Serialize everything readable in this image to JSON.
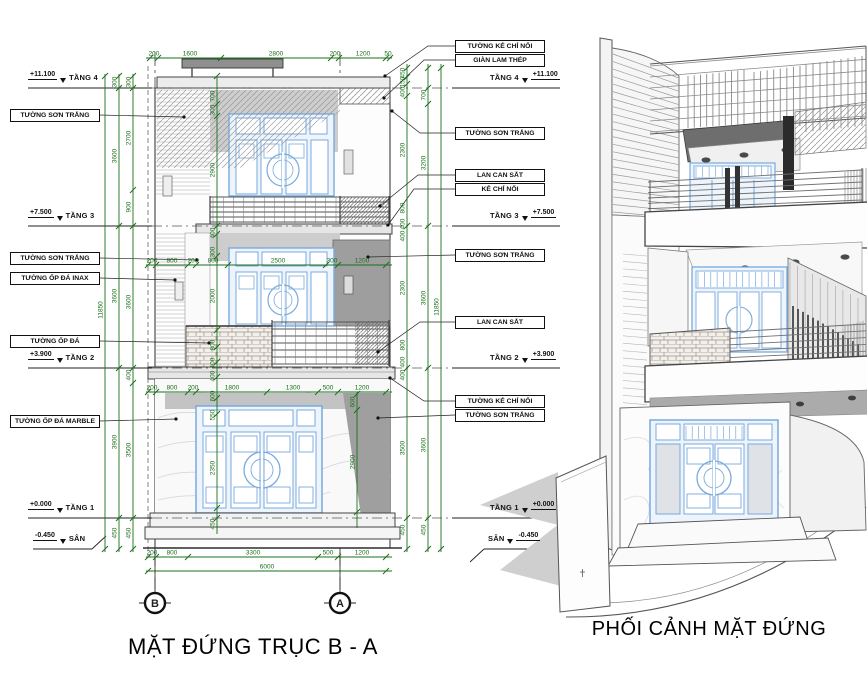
{
  "titles": {
    "elevation": "MẶT ĐỨNG TRỤC B - A",
    "perspective": "PHỐI CẢNH MẶT ĐỨNG"
  },
  "grid_bubbles": {
    "left": "B",
    "right": "A"
  },
  "levels": {
    "t4": {
      "name": "TẦNG 4",
      "elev": "+11.100"
    },
    "t3": {
      "name": "TẦNG 3",
      "elev": "+7.500"
    },
    "t2": {
      "name": "TẦNG 2",
      "elev": "+3.900"
    },
    "t1": {
      "name": "TẦNG 1",
      "elev": "+0.000"
    },
    "san": {
      "name": "SÂN",
      "elev": "-0.450"
    }
  },
  "callouts_left": [
    "TƯỜNG SƠN TRẮNG",
    "TƯỜNG SƠN TRẮNG",
    "TƯỜNG ỐP ĐÁ INAX",
    "TƯỜNG ỐP ĐÁ",
    "TƯỜNG ỐP ĐÁ MARBLE"
  ],
  "callouts_right": [
    "TƯỜNG KẺ CHỈ NỔI",
    "GIÀN LAM THÉP",
    "TƯỜNG SƠN TRẮNG",
    "LAN CAN SẮT",
    "KẺ CHỈ NỔI",
    "TƯỜNG SƠN TRẮNG",
    "LAN CAN SẮT",
    "TƯỜNG KẺ CHỈ NỔI",
    "TƯỜNG SƠN TRẮNG"
  ],
  "colors": {
    "dim_green": "#1b6f1b",
    "door_blue": "#79aadd",
    "line_dark": "#3d3d3d"
  },
  "dim_chains": [
    {
      "dir": "h",
      "pos": 58,
      "from": 146,
      "to": 392,
      "ticks": [
        150,
        158,
        221,
        331,
        339,
        386,
        390
      ],
      "labels": [
        {
          "v": "200",
          "at": 154
        },
        {
          "v": "1600",
          "at": 190
        },
        {
          "v": "2800",
          "at": 276
        },
        {
          "v": "200",
          "at": 335
        },
        {
          "v": "1200",
          "at": 363
        },
        {
          "v": "50",
          "at": 388
        }
      ]
    },
    {
      "dir": "h",
      "pos": 265,
      "from": 146,
      "to": 392,
      "ticks": [
        148,
        156,
        188,
        196,
        228,
        326,
        338,
        386
      ],
      "labels": [
        {
          "v": "200",
          "at": 152
        },
        {
          "v": "800",
          "at": 172
        },
        {
          "v": "200",
          "at": 193
        },
        {
          "v": "800",
          "at": 213
        },
        {
          "v": "2500",
          "at": 278
        },
        {
          "v": "300",
          "at": 332
        },
        {
          "v": "1200",
          "at": 362
        }
      ]
    },
    {
      "dir": "h",
      "pos": 392,
      "from": 146,
      "to": 392,
      "ticks": [
        148,
        156,
        188,
        196,
        267,
        318,
        338,
        386
      ],
      "labels": [
        {
          "v": "200",
          "at": 152
        },
        {
          "v": "800",
          "at": 172
        },
        {
          "v": "200",
          "at": 193
        },
        {
          "v": "1800",
          "at": 232
        },
        {
          "v": "1300",
          "at": 293
        },
        {
          "v": "500",
          "at": 328
        },
        {
          "v": "1200",
          "at": 362
        }
      ]
    },
    {
      "dir": "h",
      "pos": 557,
      "from": 146,
      "to": 392,
      "ticks": [
        148,
        156,
        188,
        318,
        338,
        386
      ],
      "labels": [
        {
          "v": "200",
          "at": 152
        },
        {
          "v": "800",
          "at": 172
        },
        {
          "v": "3300",
          "at": 253
        },
        {
          "v": "500",
          "at": 328
        },
        {
          "v": "1200",
          "at": 362
        }
      ]
    },
    {
      "dir": "h",
      "pos": 571,
      "from": 146,
      "to": 392,
      "ticks": [
        148,
        386
      ],
      "labels": [
        {
          "v": "6000",
          "at": 267
        }
      ]
    },
    {
      "dir": "v",
      "pos": 105,
      "from": 74,
      "to": 552,
      "ticks": [
        76,
        549
      ],
      "labels": [
        {
          "v": "11850",
          "at": 310
        }
      ]
    },
    {
      "dir": "v",
      "pos": 119,
      "from": 74,
      "to": 552,
      "ticks": [
        76,
        88,
        226,
        368,
        518,
        549
      ],
      "labels": [
        {
          "v": "300",
          "at": 82
        },
        {
          "v": "3600",
          "at": 156
        },
        {
          "v": "3600",
          "at": 296
        },
        {
          "v": "3900",
          "at": 442
        },
        {
          "v": "450",
          "at": 533
        }
      ]
    },
    {
      "dir": "v",
      "pos": 133,
      "from": 74,
      "to": 552,
      "ticks": [
        76,
        88,
        190,
        226,
        368,
        383,
        518,
        549
      ],
      "labels": [
        {
          "v": "300",
          "at": 82
        },
        {
          "v": "2700",
          "at": 138
        },
        {
          "v": "900",
          "at": 207
        },
        {
          "v": "3600",
          "at": 302
        },
        {
          "v": "400",
          "at": 375
        },
        {
          "v": "3500",
          "at": 450
        },
        {
          "v": "450",
          "at": 533
        }
      ]
    },
    {
      "dir": "v",
      "pos": 217,
      "from": 76,
      "to": 534,
      "ticks": [
        76,
        104,
        116,
        226,
        234,
        256,
        330,
        347,
        362,
        377,
        398,
        414,
        508,
        518
      ],
      "labels": [
        {
          "v": "700",
          "at": 96
        },
        {
          "v": "300",
          "at": 110
        },
        {
          "v": "2900",
          "at": 170
        },
        {
          "v": "400",
          "at": 233
        },
        {
          "v": "300",
          "at": 252
        },
        {
          "v": "2000",
          "at": 296
        },
        {
          "v": "800",
          "at": 345
        },
        {
          "v": "400",
          "at": 363
        },
        {
          "v": "400",
          "at": 376
        },
        {
          "v": "600",
          "at": 396
        },
        {
          "v": "550",
          "at": 415
        },
        {
          "v": "2350",
          "at": 468
        },
        {
          "v": "450",
          "at": 524
        }
      ]
    },
    {
      "dir": "v",
      "pos": 357,
      "from": 392,
      "to": 528,
      "ticks": [
        394,
        410,
        512
      ],
      "labels": [
        {
          "v": "600",
          "at": 402
        },
        {
          "v": "2900",
          "at": 462
        }
      ]
    },
    {
      "dir": "v",
      "pos": 407,
      "from": 64,
      "to": 552,
      "ticks": [
        68,
        77,
        84,
        96,
        226,
        368,
        518,
        549
      ],
      "labels": [
        {
          "v": "450",
          "at": 73
        },
        {
          "v": "150",
          "at": 82
        },
        {
          "v": "400",
          "at": 92
        },
        {
          "v": "2300",
          "at": 150
        },
        {
          "v": "800",
          "at": 208
        },
        {
          "v": "400",
          "at": 224
        },
        {
          "v": "400",
          "at": 236
        },
        {
          "v": "2300",
          "at": 288
        },
        {
          "v": "800",
          "at": 345
        },
        {
          "v": "400",
          "at": 362
        },
        {
          "v": "400",
          "at": 375
        },
        {
          "v": "3500",
          "at": 448
        },
        {
          "v": "450",
          "at": 530
        }
      ]
    },
    {
      "dir": "v",
      "pos": 428,
      "from": 64,
      "to": 552,
      "ticks": [
        68,
        88,
        104,
        226,
        368,
        518,
        549
      ],
      "labels": [
        {
          "v": "700",
          "at": 95
        },
        {
          "v": "3200",
          "at": 163
        },
        {
          "v": "3600",
          "at": 298
        },
        {
          "v": "3600",
          "at": 445
        },
        {
          "v": "450",
          "at": 530
        }
      ]
    },
    {
      "dir": "v",
      "pos": 441,
      "from": 64,
      "to": 552,
      "ticks": [
        68,
        549
      ],
      "labels": [
        {
          "v": "11850",
          "at": 307
        }
      ]
    }
  ]
}
